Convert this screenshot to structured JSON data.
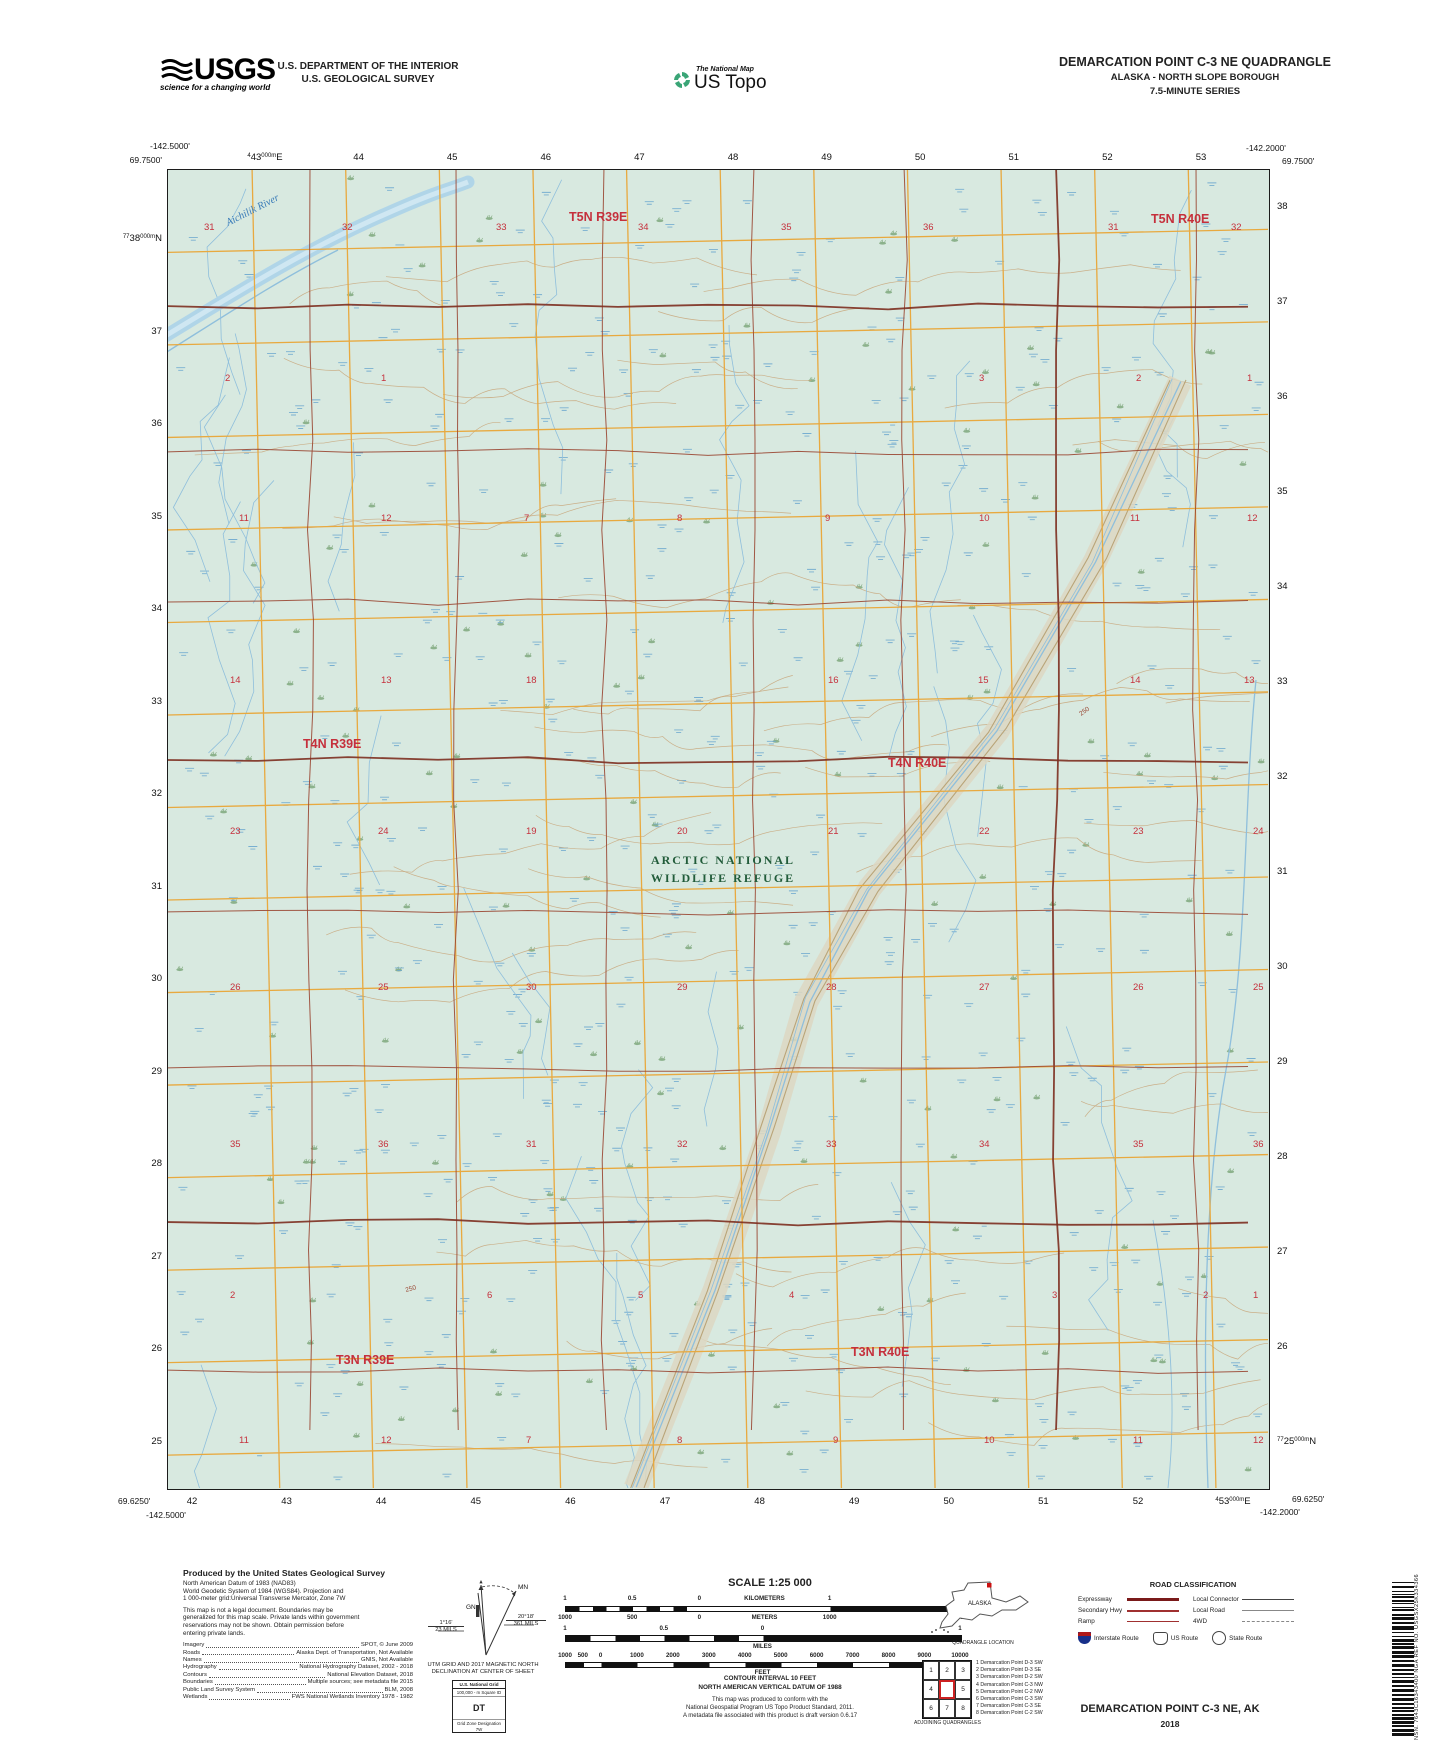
{
  "header": {
    "usgs_word": "USGS",
    "usgs_tagline": "science for a changing world",
    "dept_line1": "U.S. DEPARTMENT OF THE INTERIOR",
    "dept_line2": "U.S. GEOLOGICAL SURVEY",
    "tnm": "The National Map",
    "ustopo": "US Topo",
    "quad_title": "DEMARCATION POINT C-3 NE QUADRANGLE",
    "quad_sub1": "ALASKA - NORTH SLOPE BOROUGH",
    "quad_sub2": "7.5-MINUTE SERIES"
  },
  "map": {
    "corners": {
      "tl_lon": "-142.5000'",
      "tl_lat": "69.7500'",
      "tr_lon": "-142.2000'",
      "tr_lat": "69.7500'",
      "bl_lat": "69.6250'",
      "bl_lon": "-142.5000'",
      "br_lat": "69.6250'",
      "br_lon": "-142.2000'"
    },
    "grid": {
      "top_first": [
        "4",
        "43",
        "000m",
        "E"
      ],
      "top_rest": [
        "44",
        "45",
        "46",
        "47",
        "48",
        "49",
        "50",
        "51",
        "52",
        "53"
      ],
      "bottom_rest": [
        "42",
        "43",
        "44",
        "45",
        "46",
        "47",
        "48",
        "49",
        "50",
        "51",
        "52"
      ],
      "bottom_last": [
        "4",
        "53",
        "000m",
        "E"
      ],
      "left_first": [
        "77",
        "38",
        "000m",
        "N"
      ],
      "left_rest": [
        "37",
        "36",
        "35",
        "34",
        "33",
        "32",
        "31",
        "30",
        "29",
        "28",
        "27",
        "26",
        "25"
      ],
      "right_rest": [
        "38",
        "37",
        "36",
        "35",
        "34",
        "33",
        "32",
        "31",
        "30",
        "29",
        "28",
        "27",
        "26"
      ],
      "right_last": [
        "77",
        "25",
        "000m",
        "N"
      ]
    },
    "townships": [
      {
        "label": "T5N R39E",
        "x": 401,
        "y": 51
      },
      {
        "label": "T5N R40E",
        "x": 983,
        "y": 53
      },
      {
        "label": "T4N R39E",
        "x": 135,
        "y": 578
      },
      {
        "label": "T4N R40E",
        "x": 720,
        "y": 597
      },
      {
        "label": "T3N R39E",
        "x": 168,
        "y": 1194
      },
      {
        "label": "T3N R40E",
        "x": 683,
        "y": 1186
      }
    ],
    "sections": [
      {
        "n": "31",
        "x": 36,
        "y": 60
      },
      {
        "n": "32",
        "x": 174,
        "y": 60
      },
      {
        "n": "33",
        "x": 328,
        "y": 60
      },
      {
        "n": "34",
        "x": 470,
        "y": 60
      },
      {
        "n": "35",
        "x": 613,
        "y": 60
      },
      {
        "n": "36",
        "x": 755,
        "y": 60
      },
      {
        "n": "31",
        "x": 940,
        "y": 60
      },
      {
        "n": "32",
        "x": 1063,
        "y": 60
      },
      {
        "n": "2",
        "x": 57,
        "y": 211
      },
      {
        "n": "1",
        "x": 213,
        "y": 211
      },
      {
        "n": "3",
        "x": 811,
        "y": 211
      },
      {
        "n": "2",
        "x": 968,
        "y": 211
      },
      {
        "n": "1",
        "x": 1079,
        "y": 211
      },
      {
        "n": "11",
        "x": 71,
        "y": 351
      },
      {
        "n": "12",
        "x": 213,
        "y": 351
      },
      {
        "n": "7",
        "x": 356,
        "y": 351
      },
      {
        "n": "8",
        "x": 509,
        "y": 351
      },
      {
        "n": "9",
        "x": 657,
        "y": 351
      },
      {
        "n": "10",
        "x": 811,
        "y": 351
      },
      {
        "n": "11",
        "x": 962,
        "y": 351
      },
      {
        "n": "12",
        "x": 1079,
        "y": 351
      },
      {
        "n": "14",
        "x": 62,
        "y": 513
      },
      {
        "n": "13",
        "x": 213,
        "y": 513
      },
      {
        "n": "18",
        "x": 358,
        "y": 513
      },
      {
        "n": "16",
        "x": 660,
        "y": 513
      },
      {
        "n": "15",
        "x": 810,
        "y": 513
      },
      {
        "n": "14",
        "x": 962,
        "y": 513
      },
      {
        "n": "13",
        "x": 1076,
        "y": 513
      },
      {
        "n": "23",
        "x": 62,
        "y": 664
      },
      {
        "n": "24",
        "x": 210,
        "y": 664
      },
      {
        "n": "19",
        "x": 358,
        "y": 664
      },
      {
        "n": "20",
        "x": 509,
        "y": 664
      },
      {
        "n": "21",
        "x": 660,
        "y": 664
      },
      {
        "n": "22",
        "x": 811,
        "y": 664
      },
      {
        "n": "23",
        "x": 965,
        "y": 664
      },
      {
        "n": "24",
        "x": 1085,
        "y": 664
      },
      {
        "n": "26",
        "x": 62,
        "y": 820
      },
      {
        "n": "25",
        "x": 210,
        "y": 820
      },
      {
        "n": "30",
        "x": 358,
        "y": 820
      },
      {
        "n": "29",
        "x": 509,
        "y": 820
      },
      {
        "n": "28",
        "x": 658,
        "y": 820
      },
      {
        "n": "27",
        "x": 811,
        "y": 820
      },
      {
        "n": "26",
        "x": 965,
        "y": 820
      },
      {
        "n": "25",
        "x": 1085,
        "y": 820
      },
      {
        "n": "35",
        "x": 62,
        "y": 977
      },
      {
        "n": "36",
        "x": 210,
        "y": 977
      },
      {
        "n": "31",
        "x": 358,
        "y": 977
      },
      {
        "n": "32",
        "x": 509,
        "y": 977
      },
      {
        "n": "33",
        "x": 658,
        "y": 977
      },
      {
        "n": "34",
        "x": 811,
        "y": 977
      },
      {
        "n": "35",
        "x": 965,
        "y": 977
      },
      {
        "n": "36",
        "x": 1085,
        "y": 977
      },
      {
        "n": "2",
        "x": 62,
        "y": 1128
      },
      {
        "n": "6",
        "x": 319,
        "y": 1128
      },
      {
        "n": "5",
        "x": 470,
        "y": 1128
      },
      {
        "n": "4",
        "x": 621,
        "y": 1128
      },
      {
        "n": "3",
        "x": 884,
        "y": 1128
      },
      {
        "n": "2",
        "x": 1035,
        "y": 1128
      },
      {
        "n": "1",
        "x": 1085,
        "y": 1128
      },
      {
        "n": "11",
        "x": 71,
        "y": 1273
      },
      {
        "n": "12",
        "x": 213,
        "y": 1273
      },
      {
        "n": "7",
        "x": 358,
        "y": 1273
      },
      {
        "n": "8",
        "x": 509,
        "y": 1273
      },
      {
        "n": "9",
        "x": 665,
        "y": 1273
      },
      {
        "n": "10",
        "x": 816,
        "y": 1273
      },
      {
        "n": "11",
        "x": 965,
        "y": 1273
      },
      {
        "n": "12",
        "x": 1085,
        "y": 1273
      }
    ],
    "labels": {
      "refuge_line1": "ARCTIC NATIONAL",
      "refuge_line2": "WILDLIFE REFUGE",
      "river_name": "Aichilik River",
      "contour_value": "250"
    },
    "colors": {
      "background": "#d8e9e0",
      "grid_yellow": "#e8a93f",
      "plss_brown": "#9a4733",
      "plss_heavy": "#7d2f20",
      "section_red": "#c5303c",
      "refuge_green": "#225c3a",
      "water_blue": "#8fbfdc",
      "wetland_blue": "#6ea9cf",
      "tuft_green": "#7fa87c",
      "contour_tan": "#c9a87e"
    }
  },
  "footer": {
    "produced_by": "Produced by the United States Geological Survey",
    "datum_lines": [
      "North American Datum of 1983 (NAD83)",
      "World Geodetic System of 1984 (WGS84).  Projection and",
      "1 000-meter grid:Universal Transverse Mercator, Zone 7W",
      "This map is not a legal document. Boundaries may be",
      "generalized for this map scale. Private lands within government",
      "reservations may not be shown. Obtain permission before",
      "entering private lands."
    ],
    "credits": [
      {
        "k": "Imagery",
        "v": "SPOT,  ©  June  2009"
      },
      {
        "k": "Roads",
        "v": "Alaska Dept. of Transportation, Not Available"
      },
      {
        "k": "Names",
        "v": "GNIS, Not Available"
      },
      {
        "k": "Hydrography",
        "v": "National Hydrography Dataset, 2002 - 2018"
      },
      {
        "k": "Contours",
        "v": "National Elevation Dataset, 2018"
      },
      {
        "k": "Boundaries",
        "v": "Multiple sources; see metadata file 2015"
      },
      {
        "k": "Public Land Survey System",
        "v": "BLM, 2008"
      },
      {
        "k": "Wetlands",
        "v": "FWS National Wetlands Inventory 1978 - 1982"
      }
    ],
    "declination": {
      "gn": "GN",
      "mn": "MN",
      "left_deg": "1°16'",
      "left_mils": "23 MILS",
      "right_deg": "20°18'",
      "right_mils": "361 MILS",
      "caption1": "UTM GRID AND 2017 MAGNETIC NORTH",
      "caption2": "DECLINATION AT CENTER OF SHEET"
    },
    "usng": {
      "title": "U.S. National Grid",
      "sub": "100,000 - m Square ID",
      "square": "DT",
      "zone_label": "Grid Zone Designation",
      "zone": "7W"
    },
    "scale": {
      "title": "SCALE 1:25 000",
      "km_labels": [
        {
          "t": "1",
          "p": 0
        },
        {
          "t": "0.5",
          "p": 17
        },
        {
          "t": "0",
          "p": 34
        },
        {
          "t": "KILOMETERS",
          "p": 50.5
        },
        {
          "t": "1",
          "p": 67
        },
        {
          "t": "2",
          "p": 100
        }
      ],
      "m_labels": [
        {
          "t": "1000",
          "p": 0
        },
        {
          "t": "500",
          "p": 17
        },
        {
          "t": "0",
          "p": 34
        },
        {
          "t": "METERS",
          "p": 50.5
        },
        {
          "t": "1000",
          "p": 67
        },
        {
          "t": "2000",
          "p": 100
        }
      ],
      "mi_labels": [
        {
          "t": "1",
          "p": 0
        },
        {
          "t": "0.5",
          "p": 25
        },
        {
          "t": "0",
          "p": 50
        },
        {
          "t": "1",
          "p": 100
        }
      ],
      "mi_caption": "MILES",
      "ft_labels": [
        {
          "t": "1000",
          "p": 0
        },
        {
          "t": "500",
          "p": 4.5
        },
        {
          "t": "0",
          "p": 9
        },
        {
          "t": "1000",
          "p": 18.2
        },
        {
          "t": "2000",
          "p": 27.3
        },
        {
          "t": "3000",
          "p": 36.4
        },
        {
          "t": "4000",
          "p": 45.5
        },
        {
          "t": "5000",
          "p": 54.6
        },
        {
          "t": "6000",
          "p": 63.7
        },
        {
          "t": "7000",
          "p": 72.8
        },
        {
          "t": "8000",
          "p": 81.9
        },
        {
          "t": "9000",
          "p": 91
        },
        {
          "t": "10000",
          "p": 100
        }
      ],
      "ft_caption": "FEET",
      "note1": "CONTOUR INTERVAL 10 FEET",
      "note2": "NORTH AMERICAN VERTICAL DATUM OF 1988",
      "std_lines": [
        "This map was produced to conform with the",
        "National Geospatial Program US Topo Product Standard, 2011.",
        "A metadata file associated with this product is draft version 0.6.17"
      ]
    },
    "alaska": {
      "label": "ALASKA",
      "caption": "QUADRANGLE LOCATION"
    },
    "adjoining": {
      "cells": [
        "1",
        "2",
        "3",
        "4",
        "",
        "5",
        "6",
        "7",
        "8"
      ],
      "caption": "ADJOINING QUADRANGLES",
      "list": [
        "1 Demarcation Point D-3 SW",
        "2 Demarcation Point D-3 SE",
        "3 Demarcation Point D-2 SW",
        "4 Demarcation Point C-3 NW",
        "5 Demarcation Point C-2 NW",
        "6 Demarcation Point C-3 SW",
        "7 Demarcation Point C-3 SE",
        "8 Demarcation Point C-2 SW"
      ]
    },
    "roads": {
      "title": "ROAD CLASSIFICATION",
      "left_labels": [
        "Expressway",
        "Secondary Hwy",
        "Ramp"
      ],
      "right_labels": [
        "Local Connector",
        "Local Road",
        "4WD"
      ],
      "shield_labels": [
        "Interstate Route",
        "US Route",
        "State Route"
      ]
    },
    "sheet_title": "DEMARCATION POINT C-3 NE,  AK",
    "year": "2018",
    "nsn_label": "NSN.",
    "nsn_value": "7643C16343400",
    "nga_label": "NGA REF NO.",
    "nga_value": "USGSX25K334366"
  }
}
